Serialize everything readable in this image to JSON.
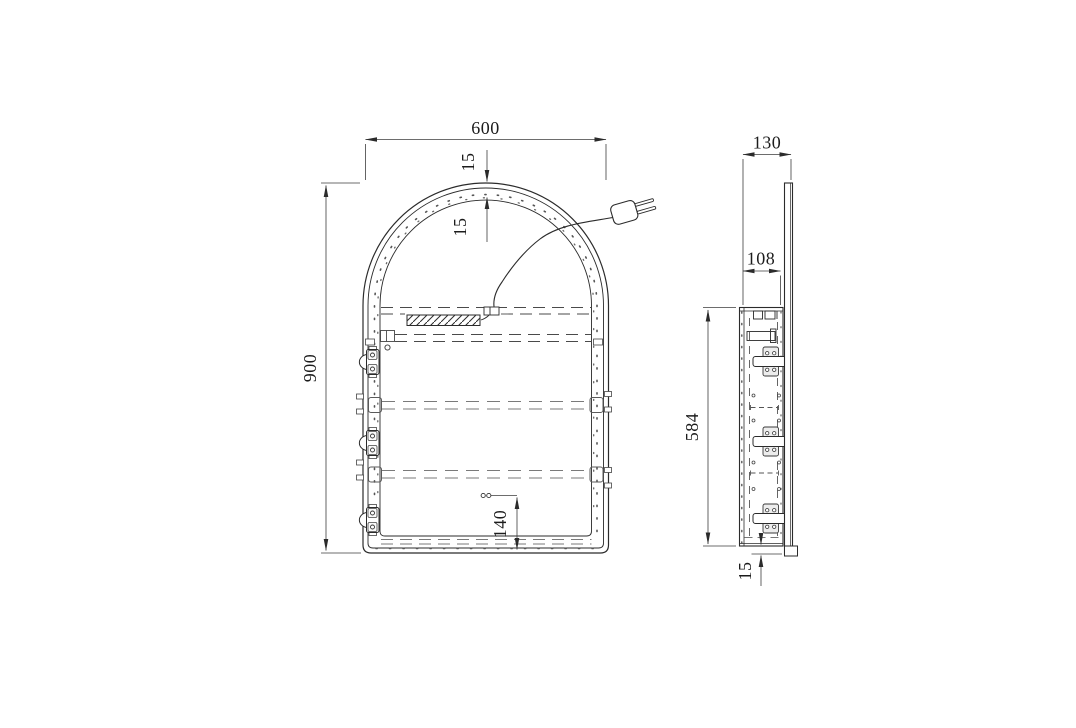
{
  "page": {
    "background": "#ffffff"
  },
  "drawing": {
    "type": "technical-drawing",
    "colors": {
      "line": "#2b2b2b",
      "dim_line": "#3d3d3d",
      "light_line": "#7a7a7a",
      "text": "#1c1c1c"
    },
    "icons": {
      "power_plug": "two-prong-plug-icon"
    },
    "front_view": {
      "dims": {
        "overall_width": "600",
        "frame_thickness": "15",
        "led_ring_width": "15",
        "overall_height": "900",
        "sensor_from_bottom": "140"
      }
    },
    "side_view": {
      "dims": {
        "overall_depth": "130",
        "backbox_depth": "108",
        "backbox_height": "584",
        "bottom_lip": "15"
      }
    }
  }
}
